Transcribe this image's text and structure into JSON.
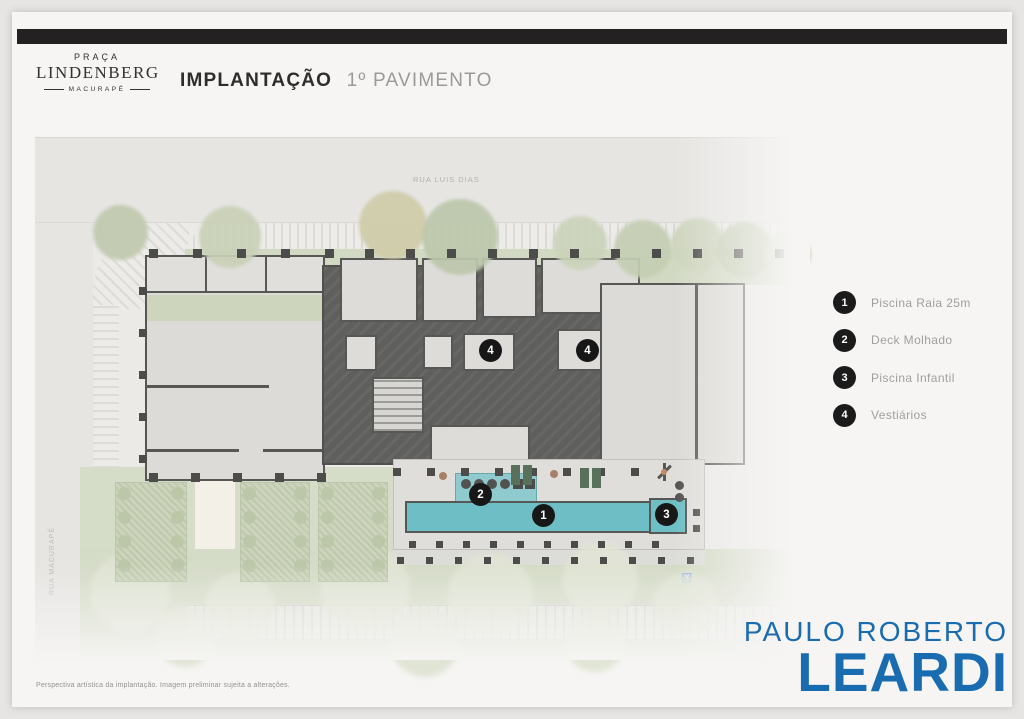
{
  "header": {
    "brand": {
      "line1": "PRAÇA",
      "line2": "LINDENBERG",
      "line3": "MACURAPÉ"
    },
    "title": "IMPLANTAÇÃO",
    "subtitle": "1º PAVIMENTO"
  },
  "plan": {
    "street_top_label": "RUA LUIS DIAS",
    "street_left_label": "RUA MACURAPÉ",
    "markers": [
      {
        "num": "1",
        "x": 509,
        "y": 379
      },
      {
        "num": "2",
        "x": 446,
        "y": 358
      },
      {
        "num": "3",
        "x": 632,
        "y": 378
      },
      {
        "num": "4",
        "x": 456,
        "y": 214
      },
      {
        "num": "4",
        "x": 553,
        "y": 214
      }
    ]
  },
  "legend": {
    "items": [
      {
        "num": "1",
        "label": "Piscina Raia 25m"
      },
      {
        "num": "2",
        "label": "Deck Molhado"
      },
      {
        "num": "3",
        "label": "Piscina Infantil"
      },
      {
        "num": "4",
        "label": "Vestiários"
      }
    ]
  },
  "footer": {
    "disclaimer": "Perspectiva artística da implantação. Imagem preliminar sujeita a alterações.",
    "logo_line1": "PAULO ROBERTO",
    "logo_line2": "LEARDI"
  },
  "colors": {
    "top_bar": "#242122",
    "pool": "#55b5be",
    "wet_deck": "#7cc2c8",
    "green": "#ccd4bb",
    "building_core": "#454544",
    "marker_black": "#171717",
    "leardi_blue": "#1a6cb0"
  }
}
